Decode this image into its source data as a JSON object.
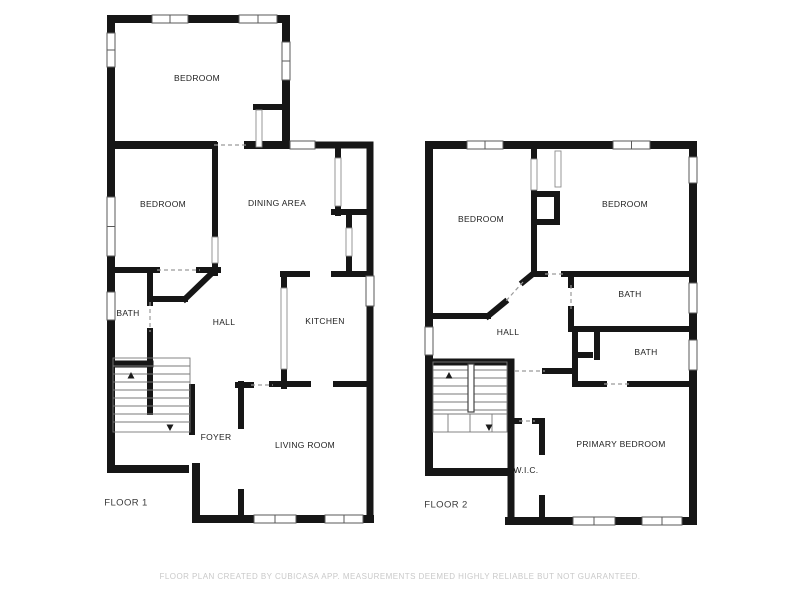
{
  "page": {
    "width": 800,
    "height": 600,
    "background": "#ffffff"
  },
  "footer": {
    "disclaimer": "FLOOR PLAN CREATED BY CUBICASA APP. MEASUREMENTS DEEMED HIGHLY RELIABLE BUT NOT GUARANTEED."
  },
  "style": {
    "wall_color": "#161616",
    "dash_color": "#9a9a9a",
    "window_fill": "#ffffff",
    "window_stroke": "#5a5a5a",
    "opening_stroke": "#8c8c8c",
    "stair_color": "#787878",
    "arrow_color": "#1c1c1c",
    "divider_stroke": "#444444"
  },
  "floors": [
    {
      "name": "FLOOR 1",
      "name_pos": [
        126,
        503
      ],
      "room_labels": [
        {
          "text": "BEDROOM",
          "x": 197,
          "y": 78
        },
        {
          "text": "BEDROOM",
          "x": 163,
          "y": 204
        },
        {
          "text": "DINING AREA",
          "x": 277,
          "y": 203
        },
        {
          "text": "BATH",
          "x": 128,
          "y": 313
        },
        {
          "text": "HALL",
          "x": 224,
          "y": 322
        },
        {
          "text": "KITCHEN",
          "x": 325,
          "y": 321
        },
        {
          "text": "FOYER",
          "x": 216,
          "y": 437
        },
        {
          "text": "LIVING ROOM",
          "x": 305,
          "y": 445
        }
      ],
      "walls": [
        [
          111,
          19,
          286,
          19,
          8
        ],
        [
          111,
          19,
          111,
          469,
          8
        ],
        [
          286,
          19,
          286,
          145,
          8
        ],
        [
          111,
          145,
          213,
          145,
          8
        ],
        [
          248,
          145,
          291,
          145,
          8
        ],
        [
          315,
          145,
          370,
          145,
          7
        ],
        [
          370,
          145,
          370,
          519,
          7
        ],
        [
          196,
          519,
          370,
          519,
          8
        ],
        [
          111,
          469,
          185,
          469,
          8
        ],
        [
          196,
          467,
          196,
          519,
          8
        ],
        [
          256,
          107,
          284,
          107,
          6
        ],
        [
          215,
          145,
          215,
          237,
          6
        ],
        [
          215,
          262,
          215,
          273,
          6
        ],
        [
          111,
          270,
          157,
          270,
          6
        ],
        [
          199,
          270,
          218,
          270,
          6
        ],
        [
          150,
          270,
          150,
          303,
          6
        ],
        [
          150,
          331,
          150,
          412,
          6
        ],
        [
          152,
          299,
          185,
          299,
          6
        ],
        [
          185,
          299,
          212,
          273,
          6
        ],
        [
          111,
          364,
          150,
          364,
          7
        ],
        [
          192,
          387,
          192,
          432,
          6
        ],
        [
          338,
          145,
          338,
          158,
          6
        ],
        [
          338,
          206,
          338,
          213,
          6
        ],
        [
          334,
          212,
          370,
          212,
          6
        ],
        [
          349,
          217,
          349,
          228,
          6
        ],
        [
          349,
          256,
          349,
          274,
          6
        ],
        [
          283,
          274,
          307,
          274,
          6
        ],
        [
          334,
          274,
          370,
          274,
          6
        ],
        [
          284,
          274,
          284,
          288,
          6
        ],
        [
          284,
          369,
          284,
          386,
          6
        ],
        [
          238,
          385,
          251,
          385,
          6
        ],
        [
          272,
          384,
          308,
          384,
          6
        ],
        [
          336,
          384,
          370,
          384,
          6
        ],
        [
          241,
          384,
          241,
          426,
          6
        ],
        [
          241,
          492,
          241,
          519,
          6
        ]
      ],
      "dashes": [
        [
          214,
          145,
          249,
          145
        ],
        [
          157,
          270,
          200,
          270
        ],
        [
          150,
          302,
          150,
          332
        ],
        [
          251,
          385,
          273,
          385
        ]
      ],
      "windows": [
        [
          152,
          15,
          36,
          8
        ],
        [
          239,
          15,
          38,
          8
        ],
        [
          107,
          33,
          8,
          34
        ],
        [
          282,
          42,
          8,
          38
        ],
        [
          107,
          197,
          8,
          59
        ],
        [
          107,
          292,
          8,
          28
        ],
        [
          290,
          141,
          25,
          8
        ],
        [
          366,
          276,
          8,
          30
        ],
        [
          254,
          515,
          42,
          8
        ],
        [
          325,
          515,
          38,
          8
        ]
      ],
      "openings": [
        [
          256,
          110,
          6,
          37
        ],
        [
          212,
          237,
          6,
          26
        ],
        [
          281,
          288,
          6,
          81
        ],
        [
          335,
          158,
          6,
          48
        ],
        [
          346,
          228,
          6,
          28
        ]
      ],
      "stairs": {
        "outline": [
          113,
          358,
          77,
          74
        ],
        "hlines": [
          [
            113,
            190,
            366
          ],
          [
            113,
            190,
            374
          ],
          [
            113,
            190,
            382
          ],
          [
            113,
            190,
            390
          ],
          [
            113,
            190,
            398
          ],
          [
            113,
            190,
            406
          ],
          [
            113,
            190,
            414
          ],
          [
            113,
            190,
            422
          ]
        ],
        "vlines": [],
        "divider": null,
        "arrows": [
          {
            "x": 131,
            "y": 376,
            "dir": "up"
          },
          {
            "x": 170,
            "y": 427,
            "dir": "down"
          }
        ]
      }
    },
    {
      "name": "FLOOR 2",
      "name_pos": [
        446,
        505
      ],
      "room_labels": [
        {
          "text": "BEDROOM",
          "x": 481,
          "y": 219
        },
        {
          "text": "BEDROOM",
          "x": 625,
          "y": 204
        },
        {
          "text": "BATH",
          "x": 630,
          "y": 294
        },
        {
          "text": "HALL",
          "x": 508,
          "y": 332
        },
        {
          "text": "BATH",
          "x": 646,
          "y": 352
        },
        {
          "text": "W.I.C.",
          "x": 526,
          "y": 470
        },
        {
          "text": "PRIMARY BEDROOM",
          "x": 621,
          "y": 444
        }
      ],
      "walls": [
        [
          429,
          145,
          693,
          145,
          8
        ],
        [
          429,
          145,
          429,
          472,
          8
        ],
        [
          693,
          145,
          693,
          521,
          8
        ],
        [
          429,
          472,
          509,
          472,
          8
        ],
        [
          509,
          521,
          693,
          521,
          8
        ],
        [
          511,
          362,
          511,
          521,
          7
        ],
        [
          534,
          145,
          534,
          159,
          6
        ],
        [
          534,
          190,
          534,
          273,
          6
        ],
        [
          534,
          194,
          557,
          194,
          6
        ],
        [
          557,
          194,
          557,
          222,
          6
        ],
        [
          534,
          222,
          557,
          222,
          6
        ],
        [
          534,
          273,
          523,
          282,
          6
        ],
        [
          505,
          302,
          488,
          316,
          6
        ],
        [
          429,
          316,
          488,
          316,
          6
        ],
        [
          534,
          274,
          545,
          274,
          6
        ],
        [
          564,
          274,
          693,
          274,
          6
        ],
        [
          571,
          274,
          571,
          285,
          6
        ],
        [
          571,
          309,
          571,
          329,
          6
        ],
        [
          571,
          329,
          693,
          329,
          6
        ],
        [
          575,
          329,
          575,
          384,
          6
        ],
        [
          575,
          355,
          590,
          355,
          6
        ],
        [
          597,
          329,
          597,
          357,
          6
        ],
        [
          575,
          384,
          604,
          384,
          6
        ],
        [
          630,
          384,
          693,
          384,
          6
        ],
        [
          545,
          371,
          575,
          371,
          6
        ],
        [
          429,
          362,
          511,
          362,
          7
        ],
        [
          511,
          421,
          519,
          421,
          6
        ],
        [
          535,
          421,
          542,
          421,
          6
        ],
        [
          542,
          421,
          542,
          452,
          6
        ],
        [
          542,
          498,
          542,
          521,
          6
        ]
      ],
      "dashes": [
        [
          523,
          282,
          505,
          302
        ],
        [
          545,
          274,
          564,
          274
        ],
        [
          571,
          285,
          571,
          309
        ],
        [
          604,
          384,
          630,
          384
        ],
        [
          515,
          371,
          545,
          371
        ],
        [
          519,
          421,
          535,
          421
        ]
      ],
      "windows": [
        [
          467,
          141,
          36,
          8
        ],
        [
          613,
          141,
          37,
          8
        ],
        [
          425,
          327,
          8,
          28
        ],
        [
          689,
          157,
          8,
          26
        ],
        [
          689,
          283,
          8,
          30
        ],
        [
          689,
          340,
          8,
          30
        ],
        [
          573,
          517,
          42,
          8
        ],
        [
          642,
          517,
          40,
          8
        ]
      ],
      "openings": [
        [
          531,
          159,
          6,
          31
        ],
        [
          555,
          151,
          6,
          36
        ]
      ],
      "stairs": {
        "outline": [
          433,
          362,
          74,
          70
        ],
        "hlines": [
          [
            433,
            507,
            370
          ],
          [
            433,
            507,
            378
          ],
          [
            433,
            507,
            386
          ],
          [
            433,
            507,
            394
          ],
          [
            433,
            507,
            402
          ],
          [
            433,
            507,
            410
          ],
          [
            433,
            507,
            414
          ]
        ],
        "vlines": [
          [
            448,
            414,
            432
          ],
          [
            470,
            414,
            432
          ],
          [
            492,
            414,
            432
          ]
        ],
        "divider": {
          "x": 468,
          "y": 364,
          "w": 6,
          "h": 48
        },
        "arrows": [
          {
            "x": 449,
            "y": 376,
            "dir": "up"
          },
          {
            "x": 489,
            "y": 427,
            "dir": "down"
          }
        ]
      }
    }
  ]
}
